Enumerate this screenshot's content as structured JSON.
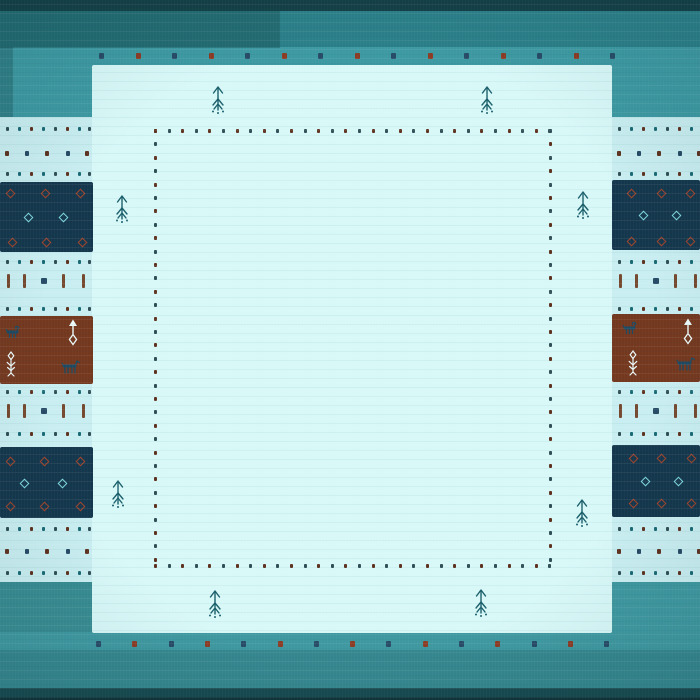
{
  "palette": {
    "top_dark": "#143f46",
    "top_band": "#2b7f88",
    "teal": "#3d99a2",
    "bottom_teal": "#3f98a0",
    "bottom_band": "#35868e",
    "bottom_dark": "#174a50",
    "bottom_edge": "#0e3338",
    "band_light": "#c9eef1",
    "field_light": "#d8f8f8",
    "navy": "#15374d",
    "brown": "#74381f",
    "dot_red": "#8c3b24",
    "dot_navy": "#274b66",
    "dot_brown": "#5f3220",
    "dot_dark": "#2f4f56",
    "dot_teal": "#1a6a75",
    "red_diamond": "#a2442a",
    "cyan_diamond": "#7fd8df",
    "animal": "#1d4a63",
    "white_motif": "#ecfbfb",
    "tree": "#1a5f6b"
  },
  "scene": {
    "size": [
      700,
      700
    ],
    "rects": [
      {
        "name": "border-top-dark-band",
        "x": 0,
        "y": 0,
        "w": 700,
        "h": 11,
        "c": "top_dark"
      },
      {
        "name": "border-top-band",
        "x": 0,
        "y": 11,
        "w": 700,
        "h": 36,
        "c": "top_band"
      },
      {
        "name": "border-top-teal",
        "x": 0,
        "y": 47,
        "w": 700,
        "h": 70,
        "c": "teal"
      },
      {
        "name": "border-bottom-teal",
        "x": 0,
        "y": 582,
        "w": 700,
        "h": 68,
        "c": "bottom_teal"
      },
      {
        "name": "border-bottom-band",
        "x": 0,
        "y": 650,
        "w": 700,
        "h": 38,
        "c": "bottom_band"
      },
      {
        "name": "border-bottom-dark-band",
        "x": 0,
        "y": 688,
        "w": 700,
        "h": 12,
        "c": "bottom_dark"
      },
      {
        "name": "border-bottom-edge",
        "x": 0,
        "y": 697,
        "w": 700,
        "h": 3,
        "c": "bottom_edge"
      },
      {
        "name": "light-cross-band",
        "x": 0,
        "y": 117,
        "w": 700,
        "h": 465,
        "c": "band_light"
      },
      {
        "name": "center-field",
        "x": 92,
        "y": 65,
        "w": 520,
        "h": 568,
        "c": "field_light",
        "r": 2
      },
      {
        "name": "shade-top-left",
        "x": 0,
        "y": 8,
        "w": 280,
        "h": 40,
        "c": "rgba(16,70,72,0.35)"
      },
      {
        "name": "shade-left-edge",
        "x": 0,
        "y": 47,
        "w": 13,
        "h": 70,
        "c": "rgba(15,60,65,0.28)"
      },
      {
        "name": "shade-bottom-left",
        "x": 0,
        "y": 582,
        "w": 92,
        "h": 50,
        "c": "rgba(30,90,85,0.18)"
      },
      {
        "name": "block-navy-left-top",
        "x": 0,
        "y": 182,
        "w": 93,
        "h": 70,
        "c": "navy",
        "r": 2
      },
      {
        "name": "block-brown-left",
        "x": 0,
        "y": 316,
        "w": 93,
        "h": 68,
        "c": "brown",
        "r": 2
      },
      {
        "name": "block-navy-left-bottom",
        "x": 0,
        "y": 447,
        "w": 93,
        "h": 71,
        "c": "navy",
        "r": 2
      },
      {
        "name": "block-navy-right-top",
        "x": 612,
        "y": 180,
        "w": 88,
        "h": 70,
        "c": "navy",
        "r": 2
      },
      {
        "name": "block-brown-right",
        "x": 612,
        "y": 314,
        "w": 88,
        "h": 68,
        "c": "brown",
        "r": 2
      },
      {
        "name": "block-navy-right-bottom",
        "x": 612,
        "y": 445,
        "w": 88,
        "h": 72,
        "c": "navy",
        "r": 2
      }
    ],
    "edge_dot_rows": [
      {
        "name": "field-top-edge-dots",
        "y": 53,
        "x0": 99,
        "n": 15,
        "dx": 36.5,
        "colors": [
          "dot_navy",
          "dot_red"
        ]
      },
      {
        "name": "field-bottom-edge-dots",
        "y": 641,
        "x0": 96,
        "n": 15,
        "dx": 36.3,
        "colors": [
          "dot_navy",
          "dot_red"
        ]
      }
    ],
    "inner_border": {
      "x1": 154,
      "x2": 549,
      "y1": 129,
      "y2": 564,
      "step_v": 13.4,
      "step_h": 13.6,
      "colors": [
        "dot_brown",
        "dot_dark"
      ]
    },
    "bands": {
      "left": {
        "x": 0,
        "w": 93
      },
      "right": {
        "x": 612,
        "w": 88
      }
    },
    "band_rows": [
      {
        "y": 127,
        "t": "dense"
      },
      {
        "y": 151,
        "t": "sparse"
      },
      {
        "y": 172,
        "t": "dense"
      },
      {
        "y": 260,
        "t": "dense"
      },
      {
        "y": 281,
        "t": "dash"
      },
      {
        "y": 307,
        "t": "dense"
      },
      {
        "y": 390,
        "t": "dense"
      },
      {
        "y": 411,
        "t": "dash"
      },
      {
        "y": 432,
        "t": "dense"
      },
      {
        "y": 527,
        "t": "dense"
      },
      {
        "y": 549,
        "t": "sparse"
      },
      {
        "y": 571,
        "t": "dense"
      }
    ],
    "row_defs": {
      "dense": {
        "offsets": [
          6,
          18,
          30,
          42,
          54,
          66,
          78,
          88
        ],
        "s": 2.8,
        "colors": [
          "dot_dark",
          "dot_teal",
          "dot_brown",
          "dot_teal",
          "dot_dark",
          "dot_brown",
          "dot_teal",
          "dot_dark"
        ]
      },
      "sparse": {
        "offsets": [
          5,
          25,
          45,
          66,
          85
        ],
        "s": 3.6,
        "colors": [
          "dot_brown",
          "dot_navy",
          "dot_brown",
          "dot_navy",
          "dot_brown"
        ]
      },
      "dash": {
        "bars": [
          7,
          23,
          62,
          82
        ],
        "bar_c": "#76492e",
        "square": 41,
        "square_c": "dot_navy"
      }
    },
    "diamonds": [
      {
        "x": 0,
        "y": 182,
        "items": [
          [
            7,
            8,
            "red_diamond"
          ],
          [
            42,
            8,
            "red_diamond"
          ],
          [
            77,
            8,
            "red_diamond"
          ],
          [
            9,
            57,
            "red_diamond"
          ],
          [
            43,
            57,
            "red_diamond"
          ],
          [
            79,
            57,
            "red_diamond"
          ],
          [
            25,
            32,
            "cyan_diamond"
          ],
          [
            60,
            32,
            "cyan_diamond"
          ]
        ]
      },
      {
        "x": 0,
        "y": 447,
        "items": [
          [
            7,
            11,
            "red_diamond"
          ],
          [
            41,
            11,
            "red_diamond"
          ],
          [
            77,
            11,
            "red_diamond"
          ],
          [
            7,
            56,
            "red_diamond"
          ],
          [
            41,
            56,
            "red_diamond"
          ],
          [
            77,
            56,
            "red_diamond"
          ],
          [
            21,
            33,
            "cyan_diamond"
          ],
          [
            59,
            33,
            "cyan_diamond"
          ]
        ]
      },
      {
        "x": 612,
        "y": 180,
        "items": [
          [
            16,
            10,
            "red_diamond"
          ],
          [
            46,
            10,
            "red_diamond"
          ],
          [
            75,
            10,
            "red_diamond"
          ],
          [
            16,
            58,
            "red_diamond"
          ],
          [
            46,
            58,
            "red_diamond"
          ],
          [
            75,
            58,
            "red_diamond"
          ],
          [
            28,
            32,
            "cyan_diamond"
          ],
          [
            61,
            32,
            "cyan_diamond"
          ]
        ]
      },
      {
        "x": 612,
        "y": 445,
        "items": [
          [
            18,
            10,
            "red_diamond"
          ],
          [
            46,
            10,
            "red_diamond"
          ],
          [
            76,
            10,
            "red_diamond"
          ],
          [
            18,
            55,
            "red_diamond"
          ],
          [
            46,
            55,
            "red_diamond"
          ],
          [
            76,
            55,
            "red_diamond"
          ],
          [
            30,
            33,
            "cyan_diamond"
          ],
          [
            63,
            33,
            "cyan_diamond"
          ]
        ]
      }
    ],
    "figures": [
      {
        "sym": "goat",
        "x": 5,
        "y": 325,
        "w": 16,
        "h": 14,
        "c": "animal"
      },
      {
        "sym": "arrow",
        "x": 66,
        "y": 318,
        "w": 14,
        "h": 28,
        "c": "white_motif"
      },
      {
        "sym": "plant",
        "x": 4,
        "y": 351,
        "w": 14,
        "h": 26,
        "c": "white_motif"
      },
      {
        "sym": "horse",
        "x": 60,
        "y": 358,
        "w": 20,
        "h": 16,
        "c": "animal"
      },
      {
        "sym": "goat",
        "x": 622,
        "y": 321,
        "w": 16,
        "h": 14,
        "c": "animal"
      },
      {
        "sym": "arrow",
        "x": 681,
        "y": 317,
        "w": 14,
        "h": 28,
        "c": "white_motif"
      },
      {
        "sym": "plant",
        "x": 626,
        "y": 350,
        "w": 14,
        "h": 26,
        "c": "white_motif"
      },
      {
        "sym": "horse",
        "x": 675,
        "y": 355,
        "w": 20,
        "h": 16,
        "c": "animal"
      }
    ],
    "trees": [
      [
        210,
        84
      ],
      [
        479,
        84
      ],
      [
        114,
        193
      ],
      [
        575,
        189
      ],
      [
        110,
        478
      ],
      [
        574,
        497
      ],
      [
        207,
        588
      ],
      [
        473,
        587
      ]
    ]
  }
}
